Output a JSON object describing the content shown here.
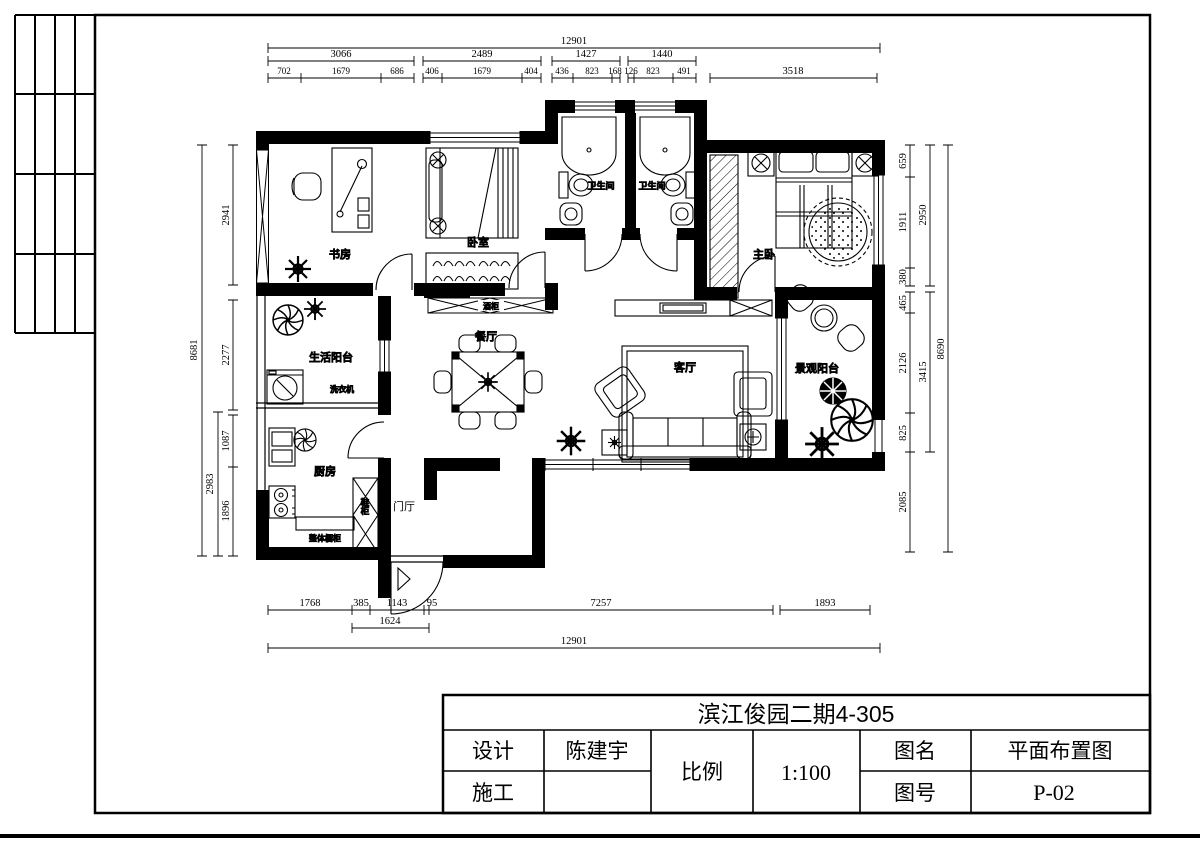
{
  "sheet": {
    "project_title": "滨江俊园二期4-305",
    "fields": {
      "design_label": "设计",
      "design_value": "陈建宇",
      "construction_label": "施工",
      "construction_value": "",
      "scale_label": "比例",
      "scale_value": "1:100",
      "drawing_name_label": "图名",
      "drawing_name_value": "平面布置图",
      "drawing_no_label": "图号",
      "drawing_no_value": "P-02"
    }
  },
  "rooms": {
    "study": "书房",
    "bedroom": "卧室",
    "bath_left": "卫生间",
    "bath_right": "卫生间",
    "master": "主卧",
    "service_balcony": "生活阳台",
    "kitchen": "厨房",
    "foyer": "门厅",
    "dining": "餐厅",
    "living": "客厅",
    "view_balcony": "景观阳台"
  },
  "annotations": {
    "washer": "洗衣机",
    "wine_cabinet": "酒柜",
    "shoe_cabinet": "鞋柜",
    "kitchen_cabinet": "整体橱柜"
  },
  "dimensions": {
    "top": {
      "overall": "12901",
      "row2": [
        "3066",
        "2489",
        "1427",
        "1440"
      ],
      "row2b": "3518",
      "row3": [
        "702",
        "1679",
        "686",
        "406",
        "1679",
        "404",
        "436",
        "823",
        "168",
        "126",
        "823",
        "491"
      ]
    },
    "bottom": {
      "row1": [
        "1768",
        "385",
        "1143",
        "95",
        "7257",
        "1893"
      ],
      "sub": "1624",
      "overall": "12901"
    },
    "left": {
      "overall": "8681",
      "mid": "2983",
      "inner": [
        "2941",
        "2277",
        "1087",
        "1896"
      ]
    },
    "right": {
      "inner": [
        "659",
        "1911",
        "380",
        "465",
        "2126",
        "825",
        "2085"
      ],
      "mid": [
        "2950",
        "3415"
      ],
      "overall": "8690"
    }
  }
}
